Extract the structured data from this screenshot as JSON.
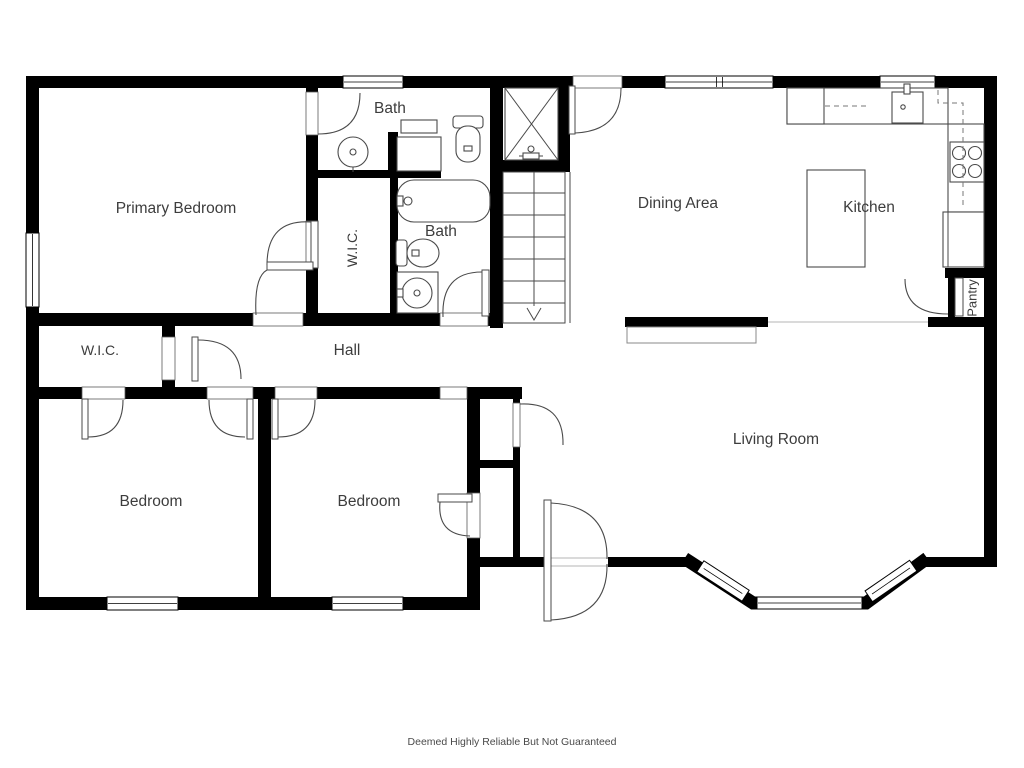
{
  "colors": {
    "wall": "#000000",
    "line": "#4a4a4a",
    "text": "#3d3d3d"
  },
  "rooms": [
    {
      "id": "primary-bedroom",
      "label": "Primary Bedroom"
    },
    {
      "id": "bath-top",
      "label": "Bath"
    },
    {
      "id": "wic-primary",
      "label": "W.I.C."
    },
    {
      "id": "bath-hall",
      "label": "Bath"
    },
    {
      "id": "dining-area",
      "label": "Dining Area"
    },
    {
      "id": "kitchen",
      "label": "Kitchen"
    },
    {
      "id": "pantry",
      "label": "Pantry"
    },
    {
      "id": "wic-hall",
      "label": "W.I.C."
    },
    {
      "id": "hall",
      "label": "Hall"
    },
    {
      "id": "bedroom-left",
      "label": "Bedroom"
    },
    {
      "id": "bedroom-middle",
      "label": "Bedroom"
    },
    {
      "id": "living-room",
      "label": "Living Room"
    }
  ],
  "fixtures": [
    "shower",
    "stairs-down",
    "bathtub",
    "toilet",
    "pedestal-sink",
    "vanity",
    "refrigerator",
    "kitchen-sink",
    "stove",
    "dishwasher",
    "kitchen-island",
    "half-wall",
    "bay-window",
    "front-door"
  ],
  "footer": {
    "disclaimer": "Deemed Highly Reliable But Not Guaranteed"
  }
}
